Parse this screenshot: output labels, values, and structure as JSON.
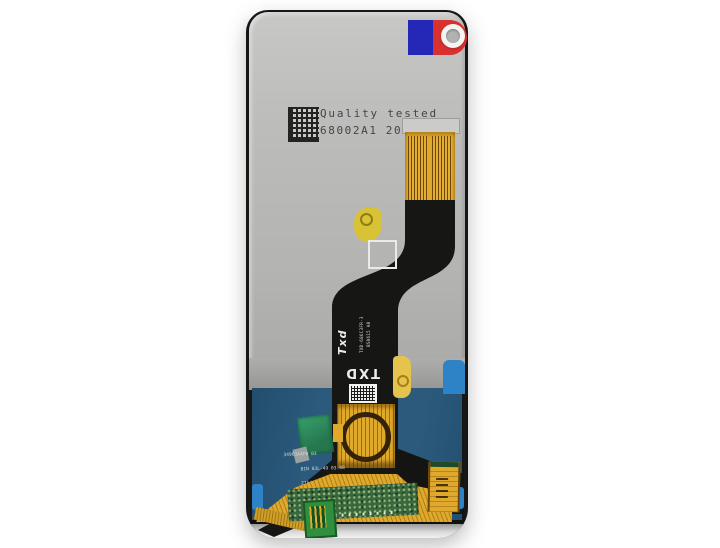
{
  "stamp": {
    "line1": "Quality tested",
    "line2": "68002A1 2020/11/1"
  },
  "flex": {
    "logo": "Txd",
    "part_no": "TXD-686C3FR-3",
    "code": "BS0615 A0",
    "txd_mark": "TXD",
    "bottom_line1": "34963A4FB 03",
    "bottom_line2": "BIN 03L-49 03.08",
    "bottom_line3": "2754  417"
  },
  "colors": {
    "film": "#2b5a7d",
    "film_tab": "#2e82c6",
    "gold": "#dfa92c",
    "flex_black": "#161614",
    "sticker_red": "#d93030",
    "sticker_blue": "#2527b6",
    "pcb_green": "#3a673d",
    "conn_green": "#2f8f3f"
  }
}
